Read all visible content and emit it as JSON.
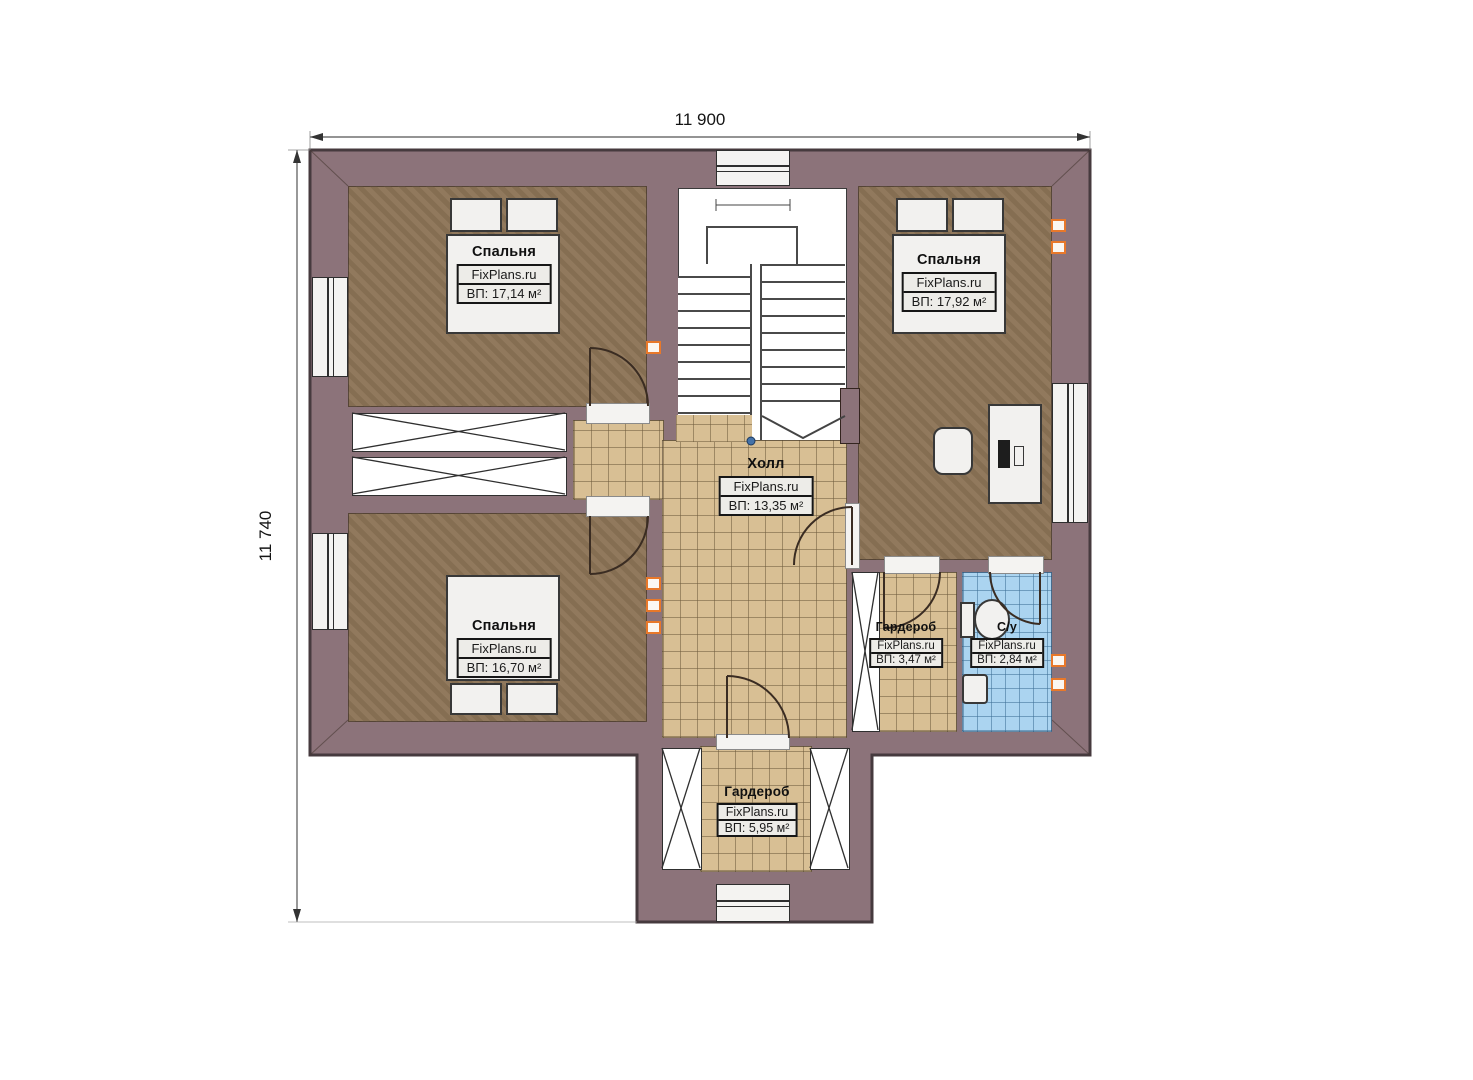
{
  "plan": {
    "type": "floor-plan",
    "dimensions": {
      "top": "11 900",
      "left": "11 740"
    },
    "brand": "FixPlans.ru",
    "colors": {
      "wall": "#8c737a",
      "wall_outline": "#463a3e",
      "bedroom_floor": "#8c7456",
      "tile_floor": "#d8bf94",
      "bathroom_floor": "#abd4f0",
      "vent_accent": "#e8782a",
      "label_box_bg": "#edece8"
    },
    "rooms": {
      "bedroom_tl": {
        "name": "Спальня",
        "brand": "FixPlans.ru",
        "area": "ВП: 17,14 м²"
      },
      "bedroom_tr": {
        "name": "Спальня",
        "brand": "FixPlans.ru",
        "area": "ВП: 17,92 м²"
      },
      "bedroom_bl": {
        "name": "Спальня",
        "brand": "FixPlans.ru",
        "area": "ВП: 16,70 м²"
      },
      "hall": {
        "name": "Холл",
        "brand": "FixPlans.ru",
        "area": "ВП: 13,35 м²"
      },
      "wardrobe_right": {
        "name": "Гардероб",
        "brand": "FixPlans.ru",
        "area": "ВП: 3,47 м²"
      },
      "bathroom": {
        "name": "С/у",
        "brand": "FixPlans.ru",
        "area": "ВП: 2,84 м²"
      },
      "wardrobe_bottom": {
        "name": "Гардероб",
        "brand": "FixPlans.ru",
        "area": "ВП: 5,95 м²"
      }
    }
  }
}
